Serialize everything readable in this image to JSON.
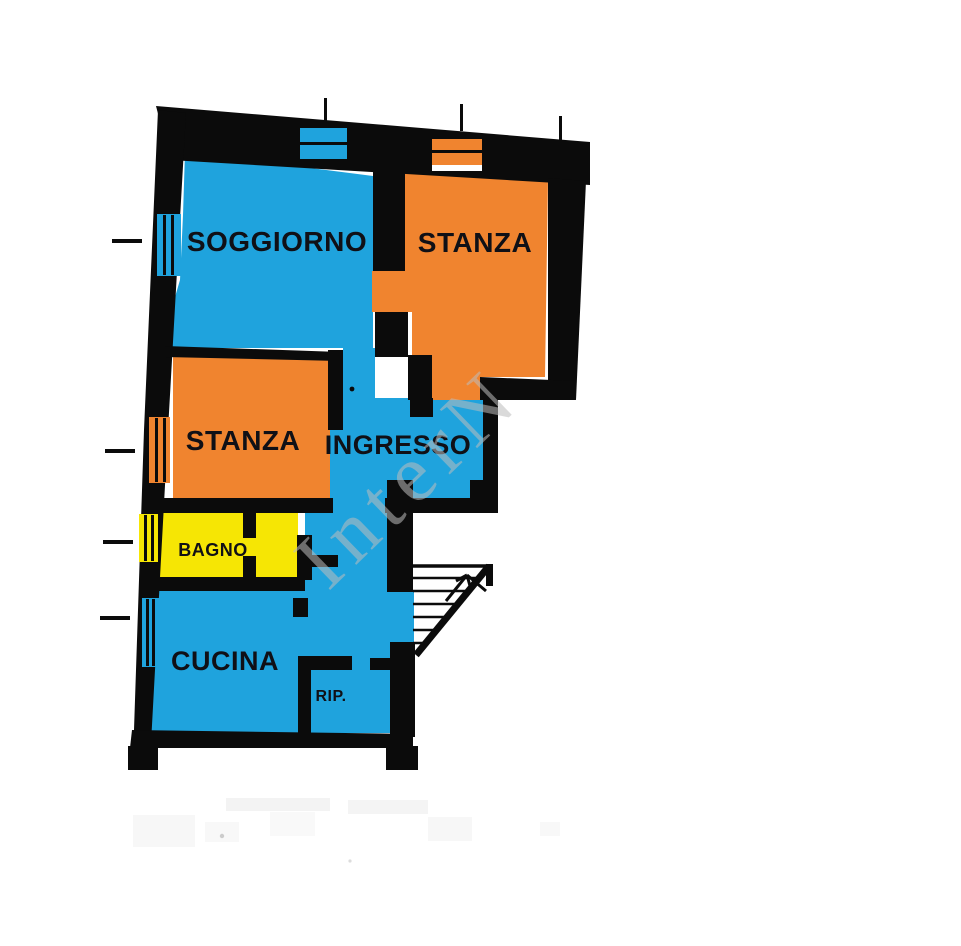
{
  "title": "Planimetria appartamento",
  "colors": {
    "blue": "#1fa3dd",
    "orange": "#f0842f",
    "yellow": "#f6e604",
    "wall": "#0b0b0b",
    "label": "#101016",
    "watermark": "#bdbdbd",
    "background": "#ffffff"
  },
  "rooms": {
    "soggiorno": {
      "label": "SOGGIORNO",
      "color": "#1fa3dd"
    },
    "stanza_top": {
      "label": "STANZA",
      "color": "#f0842f"
    },
    "stanza_mid": {
      "label": "STANZA",
      "color": "#f0842f"
    },
    "ingresso": {
      "label": "INGRESSO",
      "color": "#1fa3dd"
    },
    "bagno": {
      "label": "BAGNO",
      "color": "#f6e604"
    },
    "cucina": {
      "label": "CUCINA",
      "color": "#1fa3dd"
    },
    "rip": {
      "label": "RIP.",
      "color": "#1fa3dd"
    }
  },
  "watermark": {
    "text": "InterN"
  }
}
